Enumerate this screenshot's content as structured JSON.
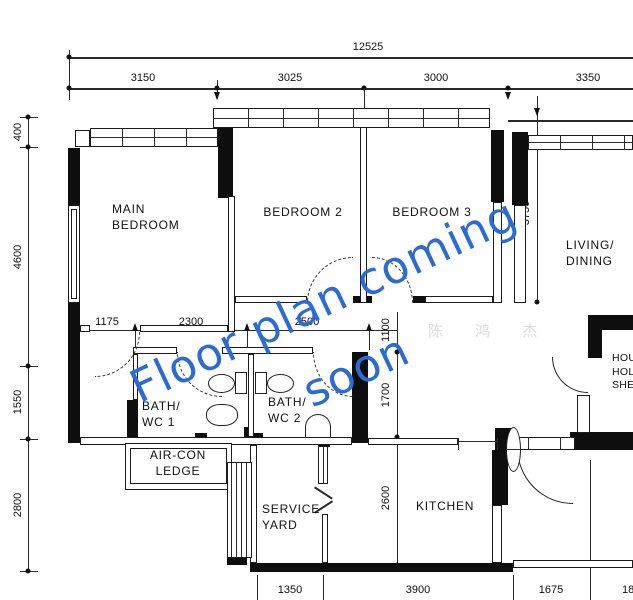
{
  "plan": {
    "dims": {
      "total_width": "12525",
      "top": [
        "3150",
        "3025",
        "3000",
        "3350"
      ],
      "left": [
        "400",
        "4600",
        "1550",
        "2800"
      ],
      "middle": [
        "1175",
        "2300",
        "2500"
      ],
      "vertical": {
        "living": "3750",
        "hall": "1100",
        "bath": "1700",
        "kitchen": "2600"
      },
      "bottom": [
        "1350",
        "3900",
        "1675",
        "18"
      ]
    },
    "rooms": {
      "main_bedroom": "MAIN\nBEDROOM",
      "bedroom2": "BEDROOM 2",
      "bedroom3": "BEDROOM 3",
      "living": "LIVING/\nDINING",
      "bath1": "BATH/\nWC 1",
      "bath2": "BATH/\nWC 2",
      "aircon": "AIR-CON\nLEDGE",
      "service_yard": "SERVICE\nYARD",
      "kitchen": "KITCHEN",
      "shelter": "HOUSE-\nHOLD\nSHELTER"
    }
  },
  "watermark": {
    "line1": "Floor plan coming",
    "line2": "soon",
    "artist": "陈 鸿 杰"
  },
  "colors": {
    "watermark_blue": "#2c6bd3",
    "watermark_gray": "#dcdcdc",
    "line": "#1a1a1a"
  }
}
